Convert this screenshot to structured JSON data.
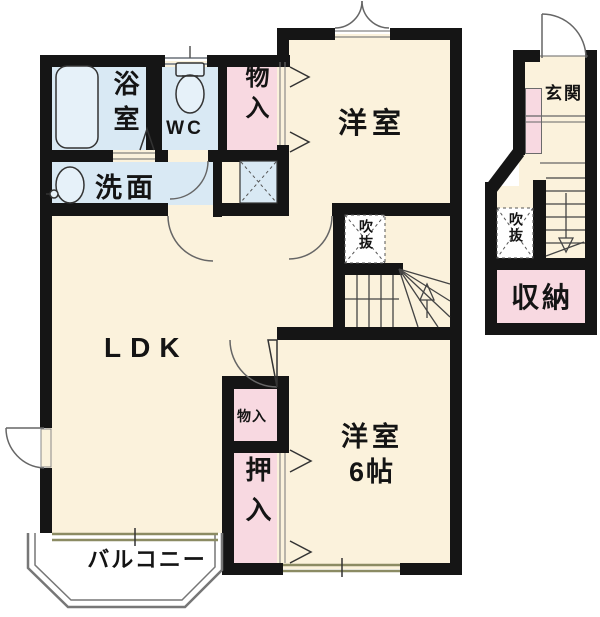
{
  "plan": {
    "type": "floor-plan",
    "rooms": {
      "bath": "浴室",
      "toilet": "WC",
      "storage_top": "物入",
      "bedroom1": "洋室",
      "washroom": "洗面",
      "void_upper": "吹抜",
      "ldk": "LDK",
      "storage_mid": "物入",
      "closet": "押入",
      "bedroom2_name": "洋室",
      "bedroom2_size": "6帖",
      "balcony": "バルコニー",
      "entrance": "玄関",
      "void_lower": "吹抜",
      "storage_entrance": "収納"
    },
    "palette": {
      "floor": "#FBF2DC",
      "wet": "#D9E9F4",
      "closet_pink": "#F8D9E1",
      "wall": "#151515",
      "win_gray": "#8F949A",
      "win_tan": "#8B8B63",
      "line": "#555555",
      "white": "#FFFFFF"
    }
  }
}
